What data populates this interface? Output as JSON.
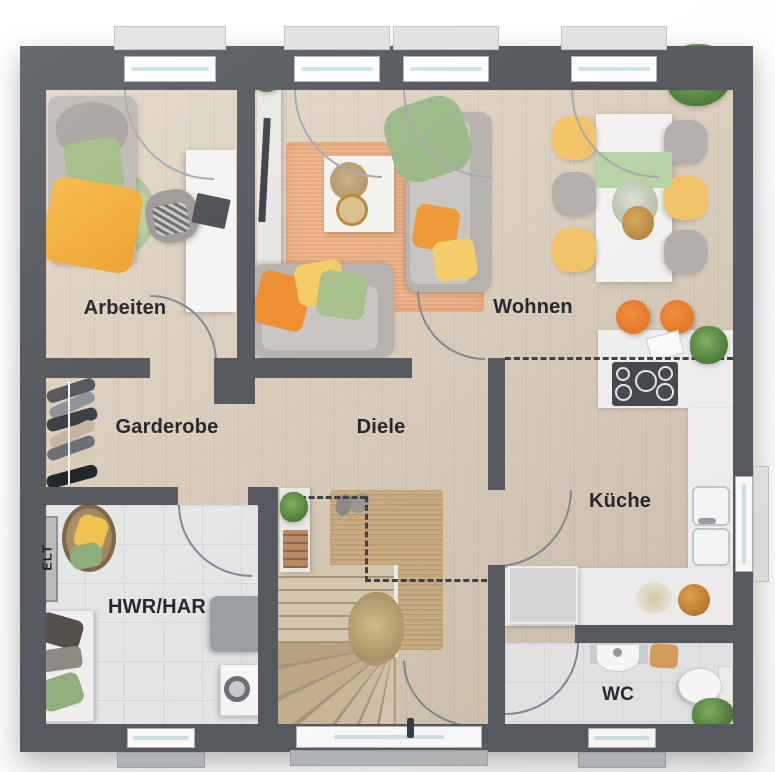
{
  "rooms": {
    "arbeiten": {
      "label": "Arbeiten"
    },
    "wohnen": {
      "label": "Wohnen"
    },
    "garderobe": {
      "label": "Garderobe"
    },
    "diele": {
      "label": "Diele"
    },
    "kueche": {
      "label": "Küche"
    },
    "hwr": {
      "label": "HWR/HAR"
    },
    "wc": {
      "label": "WC"
    },
    "elt": {
      "label": "ELT"
    }
  },
  "colors": {
    "wall": "#575b60",
    "wood_floor": "#d9cbb8",
    "tile_floor": "#e6e7e9",
    "accent_orange": "#ee8f3a",
    "accent_yellow": "#f2c75c",
    "accent_green": "#a9c28c",
    "rug_orange": "#eeb286",
    "rug_jute": "#c8a87d"
  }
}
